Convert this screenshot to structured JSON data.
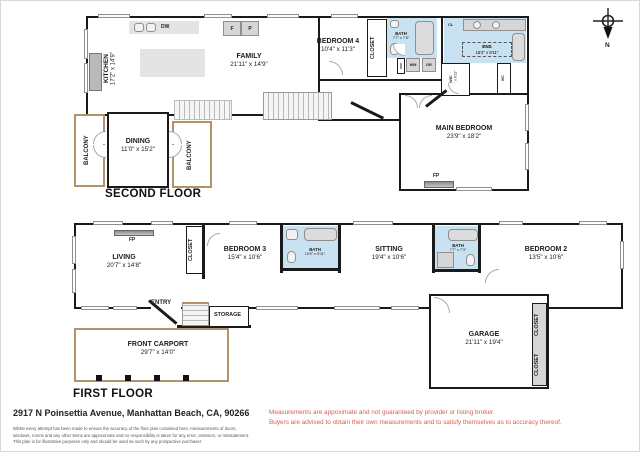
{
  "floors": {
    "second": {
      "title": "SECOND FLOOR"
    },
    "first": {
      "title": "FIRST FLOOR"
    }
  },
  "compass": {
    "north_label": "N"
  },
  "rooms": {
    "kitchen": {
      "name": "KITCHEN",
      "dims": "17'2\" x 14'9\""
    },
    "family": {
      "name": "FAMILY",
      "dims": "21'11\" x 14'9\""
    },
    "bedroom4": {
      "name": "BEDROOM 4",
      "dims": "10'4\" x 11'3\""
    },
    "closet_b4": {
      "name": "CLOSET"
    },
    "bath_2f": {
      "name": "BATH",
      "dims": "7'7\" x 7'6\""
    },
    "ens": {
      "name": "ENS",
      "dims": "16'2\" x 8'11\""
    },
    "wic": {
      "name": "WIC",
      "dims": "6'1\" x 8'11\""
    },
    "wc": {
      "name": "WC"
    },
    "main_bedroom": {
      "name": "MAIN BEDROOM",
      "dims": "23'9\" x 18'2\""
    },
    "dining": {
      "name": "DINING",
      "dims": "11'0\" x 15'2\""
    },
    "balcony_left": {
      "name": "BALCONY"
    },
    "balcony_right": {
      "name": "BALCONY"
    },
    "living": {
      "name": "LIVING",
      "dims": "20'7\" x 14'8\""
    },
    "closet_1f": {
      "name": "CLOSET"
    },
    "bedroom3": {
      "name": "BEDROOM 3",
      "dims": "15'4\" x 10'6\""
    },
    "bath_1f_small": {
      "name": "BATH",
      "dims": "10'5\" x 5'11\""
    },
    "sitting": {
      "name": "SITTING",
      "dims": "19'4\" x 10'6\""
    },
    "bath_1f": {
      "name": "BATH",
      "dims": "7'7\" x 7'3\""
    },
    "bedroom2": {
      "name": "BEDROOM 2",
      "dims": "13'5\" x 10'6\""
    },
    "entry": {
      "name": "ENTRY"
    },
    "storage": {
      "name": "STORAGE"
    },
    "carport": {
      "name": "FRONT CARPORT",
      "dims": "29'7\" x 14'0\""
    },
    "garage": {
      "name": "GARAGE",
      "dims": "21'11\" x 19'4\""
    },
    "closet_g_top": {
      "name": "CLOSET"
    },
    "closet_g_bottom": {
      "name": "CLOSET"
    }
  },
  "fixtures": {
    "dishwasher": "DW",
    "fridge": "F",
    "pantry": "P",
    "washer": "WM",
    "dryer": "DR",
    "closet_small": "CL",
    "cupboard": "CUP",
    "fireplace_second": "FP",
    "fireplace_first": "FP"
  },
  "footer": {
    "address": "2917 N Poinsettia Avenue, Manhattan Beach, CA, 90266",
    "disclaimer_lines": [
      "Whilst every attempt has been made to ensure the accuracy of the floor plan contained here, measurements of doors,",
      "windows, rooms and any other items are approximate and no responsibility is taken for any error, omission, or misstatement.",
      "This plan is for illustrative purposes only and should be used as such by any prospective purchaser"
    ],
    "notice_lines": [
      "Measurements are appoximate and not guaranteed by provider or listing broker.",
      "Buyers are advised to obtain their own measurements and to satisfy themselves as to accuracy thereof."
    ]
  },
  "colors": {
    "wall": "#1a1a1a",
    "bath_fill": "#c9e2f1",
    "fixture_gray": "#d6d6d6",
    "balcony_outline": "#b3916b",
    "notice_red": "#d4614e"
  }
}
